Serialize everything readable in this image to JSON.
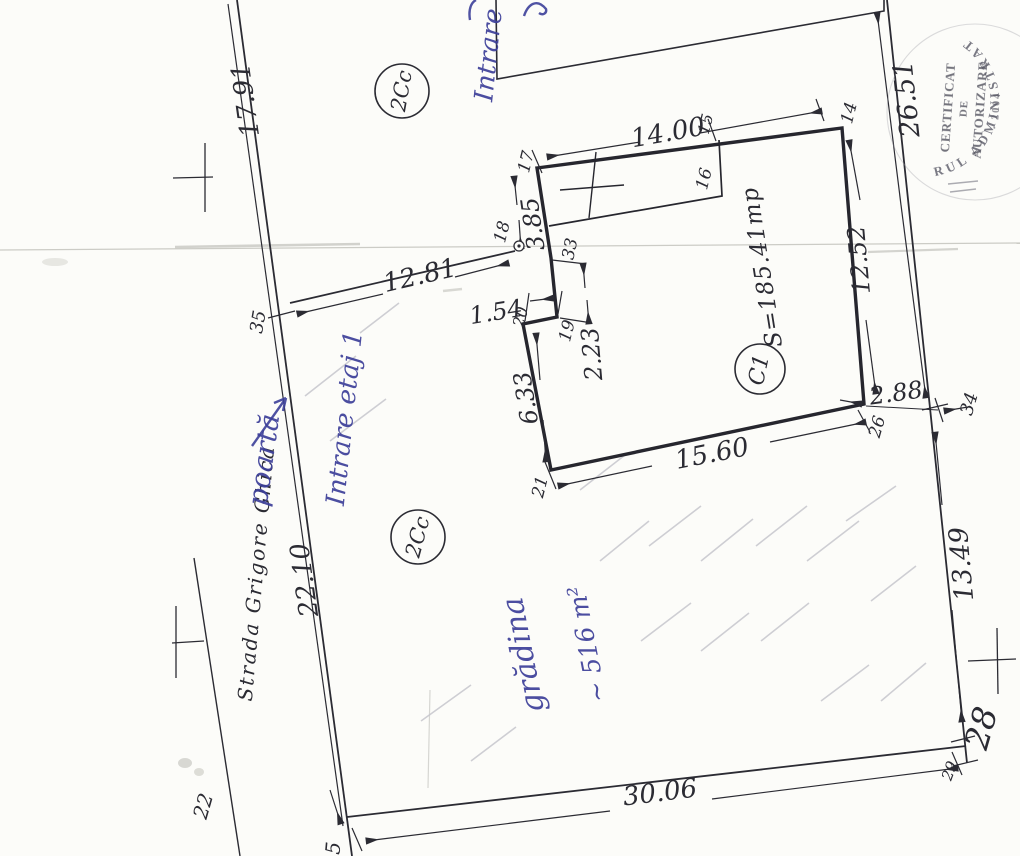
{
  "plan": {
    "street_name": "Strada Grigore Ghica",
    "zone_label_upper": "2Cc",
    "zone_label_lower": "2Cc",
    "building": {
      "id": "C1",
      "area": "S=185.41mp"
    },
    "dimensions": {
      "street_upper": "17.91",
      "street_lower": "22.10",
      "fence": "12.81",
      "right_upper": "26.51",
      "right_lower": "13.49",
      "bottom": "30.06",
      "building_top": "14.00",
      "building_right": "12.52",
      "building_bottom": "15.60",
      "building_left": "6.33",
      "wall_upper": "3.85",
      "notch_width": "1.54",
      "notch_height": "2.23",
      "gap_to_boundary": "2.88"
    },
    "points": {
      "p5": "5",
      "p14": "14",
      "p15": "15",
      "p16": "16",
      "p17": "17",
      "p18": "18",
      "p19": "19",
      "p20": "20",
      "p21": "21",
      "p22": "22",
      "p26": "26",
      "p28": "28",
      "p29": "29",
      "p33": "33",
      "p34": "34",
      "p35": "35"
    }
  },
  "handwriting": {
    "top_entrance": "Intrare",
    "entrance_floor": "Intrare etaj 1",
    "gate": "poartă",
    "garden_name": "grădina",
    "garden_area": "~ 516 m²"
  },
  "stamp": {
    "arc_text": "RUL ADMINISTRAT",
    "line1": "CERTIFICAT",
    "line2": "DE",
    "line3": "AUTORIZARE",
    "line4": "· 2004"
  },
  "colors": {
    "ink": "#2b2b33",
    "pen": "#3c3f99",
    "stamp": "#555562",
    "pencil": "#c4c4cb"
  }
}
